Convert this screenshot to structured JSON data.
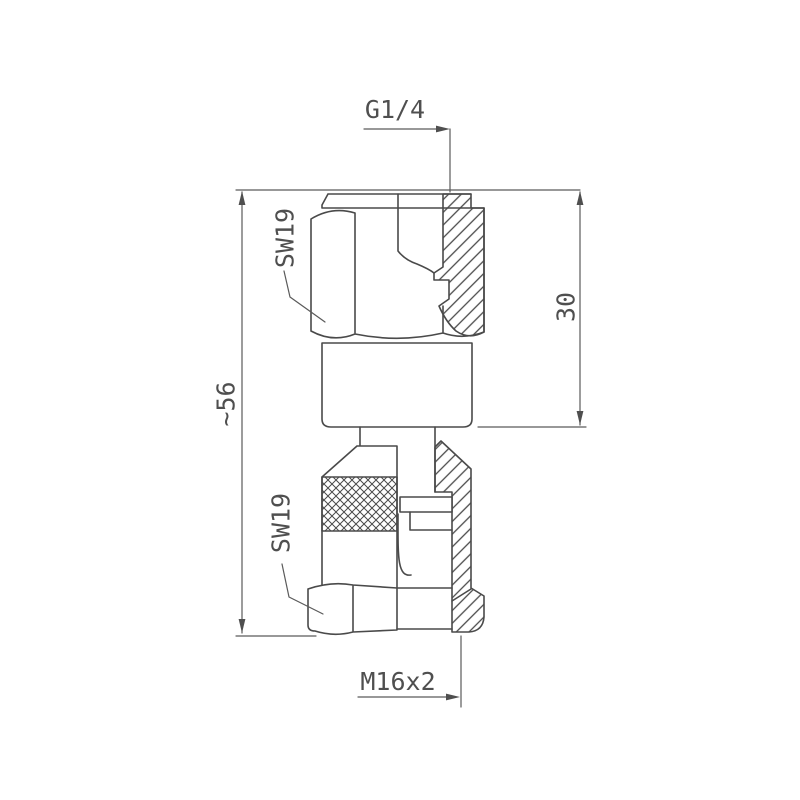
{
  "drawing": {
    "labels": {
      "top_thread": "G1/4",
      "wrench_size_top": "SW19",
      "wrench_size_bottom": "SW19",
      "overall_length": "~56",
      "upper_section_length": "30",
      "bottom_thread": "M16x2"
    },
    "colors": {
      "background": "#ffffff",
      "part_line": "#4a4a4a",
      "dimension_line": "#5a5a5a",
      "text": "#4f4f4f"
    }
  }
}
